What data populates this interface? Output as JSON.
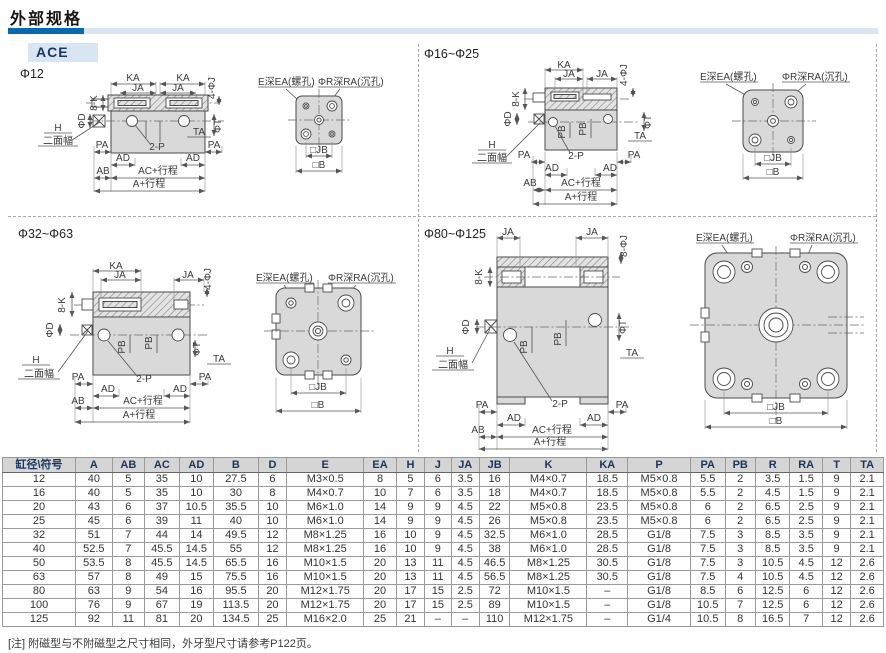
{
  "page": {
    "title": "外部规格",
    "series_badge": "ACE",
    "note": "[注] 附磁型与不附磁型之尺寸相同，外牙型尺寸请参考P122页。",
    "accent_dark": "#0669b2",
    "accent_light": "#d8e5f3",
    "header_text_color": "#17365f"
  },
  "drawings": {
    "labels": {
      "ka": "KA",
      "ja": "JA",
      "k8": "8-K",
      "j4": "4-ΦJ",
      "j8": "8-ΦJ",
      "phi_d": "ΦD",
      "phi_t": "ΦT",
      "ta": "TA",
      "h": "H",
      "flats": "二面幅",
      "pa": "PA",
      "pb": "PB",
      "p2": "2-P",
      "ad": "AD",
      "ab": "AB",
      "ac_stroke": "AC+行程",
      "a_stroke": "A+行程",
      "thread": "E深EA(螺孔)",
      "cbore": "ΦR深RA(沉孔)",
      "jb": "□JB",
      "b": "□B"
    },
    "quadrants": [
      {
        "title": "Φ12"
      },
      {
        "title": "Φ16~Φ25"
      },
      {
        "title": "Φ32~Φ63"
      },
      {
        "title": "Φ80~Φ125"
      }
    ]
  },
  "table": {
    "headers": [
      "缸径\\符号",
      "A",
      "AB",
      "AC",
      "AD",
      "B",
      "D",
      "E",
      "EA",
      "H",
      "J",
      "JA",
      "JB",
      "K",
      "KA",
      "P",
      "PA",
      "PB",
      "R",
      "RA",
      "T",
      "TA"
    ],
    "rows": [
      [
        "12",
        "40",
        "5",
        "35",
        "10",
        "27.5",
        "6",
        "M3×0.5",
        "8",
        "5",
        "6",
        "3.5",
        "16",
        "M4×0.7",
        "18.5",
        "M5×0.8",
        "5.5",
        "2",
        "3.5",
        "1.5",
        "9",
        "2.1"
      ],
      [
        "16",
        "40",
        "5",
        "35",
        "10",
        "30",
        "8",
        "M4×0.7",
        "10",
        "7",
        "6",
        "3.5",
        "18",
        "M4×0.7",
        "18.5",
        "M5×0.8",
        "5.5",
        "2",
        "4.5",
        "1.5",
        "9",
        "2.1"
      ],
      [
        "20",
        "43",
        "6",
        "37",
        "10.5",
        "35.5",
        "10",
        "M6×1.0",
        "14",
        "9",
        "9",
        "4.5",
        "22",
        "M5×0.8",
        "23.5",
        "M5×0.8",
        "6",
        "2",
        "6.5",
        "2.5",
        "9",
        "2.1"
      ],
      [
        "25",
        "45",
        "6",
        "39",
        "11",
        "40",
        "10",
        "M6×1.0",
        "14",
        "9",
        "9",
        "4.5",
        "26",
        "M5×0.8",
        "23.5",
        "M5×0.8",
        "6",
        "2",
        "6.5",
        "2.5",
        "9",
        "2.1"
      ],
      [
        "32",
        "51",
        "7",
        "44",
        "14",
        "49.5",
        "12",
        "M8×1.25",
        "16",
        "10",
        "9",
        "4.5",
        "32.5",
        "M6×1.0",
        "28.5",
        "G1/8",
        "7.5",
        "3",
        "8.5",
        "3.5",
        "9",
        "2.1"
      ],
      [
        "40",
        "52.5",
        "7",
        "45.5",
        "14.5",
        "55",
        "12",
        "M8×1.25",
        "16",
        "10",
        "9",
        "4.5",
        "38",
        "M6×1.0",
        "28.5",
        "G1/8",
        "7.5",
        "3",
        "8.5",
        "3.5",
        "9",
        "2.1"
      ],
      [
        "50",
        "53.5",
        "8",
        "45.5",
        "14.5",
        "65.5",
        "16",
        "M10×1.5",
        "20",
        "13",
        "11",
        "4.5",
        "46.5",
        "M8×1.25",
        "30.5",
        "G1/8",
        "7.5",
        "3",
        "10.5",
        "4.5",
        "12",
        "2.6"
      ],
      [
        "63",
        "57",
        "8",
        "49",
        "15",
        "75.5",
        "16",
        "M10×1.5",
        "20",
        "13",
        "11",
        "4.5",
        "56.5",
        "M8×1.25",
        "30.5",
        "G1/8",
        "7.5",
        "4",
        "10.5",
        "4.5",
        "12",
        "2.6"
      ],
      [
        "80",
        "63",
        "9",
        "54",
        "16",
        "95.5",
        "20",
        "M12×1.75",
        "20",
        "17",
        "15",
        "2.5",
        "72",
        "M10×1.5",
        "–",
        "G1/8",
        "8.5",
        "6",
        "12.5",
        "6",
        "12",
        "2.6"
      ],
      [
        "100",
        "76",
        "9",
        "67",
        "19",
        "113.5",
        "20",
        "M12×1.75",
        "20",
        "17",
        "15",
        "2.5",
        "89",
        "M10×1.5",
        "–",
        "G1/8",
        "10.5",
        "7",
        "12.5",
        "6",
        "12",
        "2.6"
      ],
      [
        "125",
        "92",
        "11",
        "81",
        "20",
        "134.5",
        "25",
        "M16×2.0",
        "25",
        "21",
        "–",
        "–",
        "110",
        "M12×1.75",
        "–",
        "G1/4",
        "10.5",
        "8",
        "16.5",
        "7",
        "12",
        "2.6"
      ]
    ]
  }
}
